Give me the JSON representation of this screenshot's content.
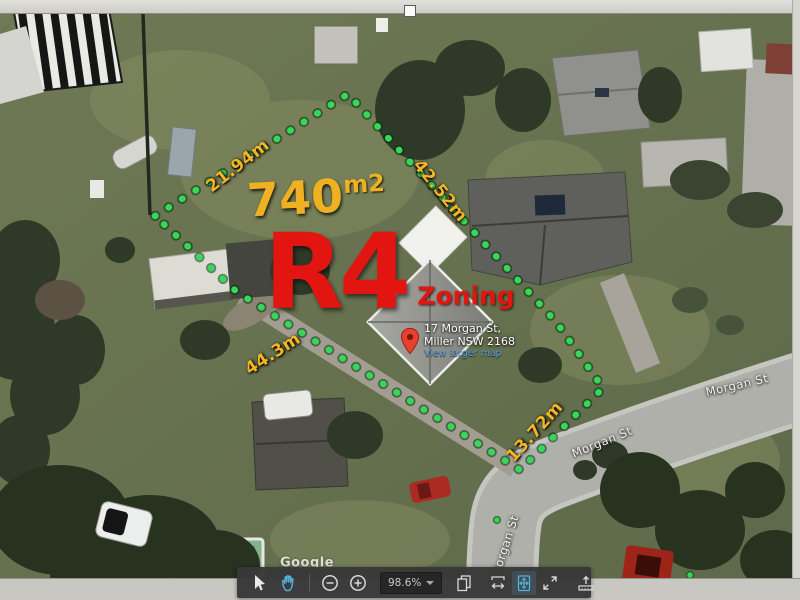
{
  "map": {
    "watermark": "Google",
    "street_labels": [
      "Morgan St",
      "Morgan St",
      "Morgan St"
    ],
    "marker": {
      "address_line1": "17 Morgan St,",
      "address_line2": "Miller NSW 2168",
      "link_text": "View larger map"
    },
    "annotations": {
      "area_value": "740",
      "area_unit": "m2",
      "zoning_code": "R4",
      "zoning_label": "Zoning",
      "measurements": [
        "21.94m",
        "42.52m",
        "44.3m",
        "13.72m"
      ],
      "colors": {
        "boundary_green": "#35d858",
        "measurement_gold": "#f2b526",
        "zoning_red": "#e21510",
        "pin_red": "#e8402f"
      }
    }
  },
  "toolbar": {
    "zoom_level": "98.6%",
    "active_color": "#55b0dc",
    "icons": [
      {
        "name": "select-cursor",
        "active": false
      },
      {
        "name": "pan-hand",
        "active": true
      },
      {
        "name": "zoom-out",
        "active": false
      },
      {
        "name": "zoom-in",
        "active": false
      },
      {
        "name": "zoom-level-dropdown",
        "active": false
      },
      {
        "name": "copy-pages",
        "active": false
      },
      {
        "name": "fit-width",
        "active": false
      },
      {
        "name": "fit-page",
        "active": true
      },
      {
        "name": "fullscreen",
        "active": false
      },
      {
        "name": "export-measure",
        "active": false
      }
    ]
  }
}
